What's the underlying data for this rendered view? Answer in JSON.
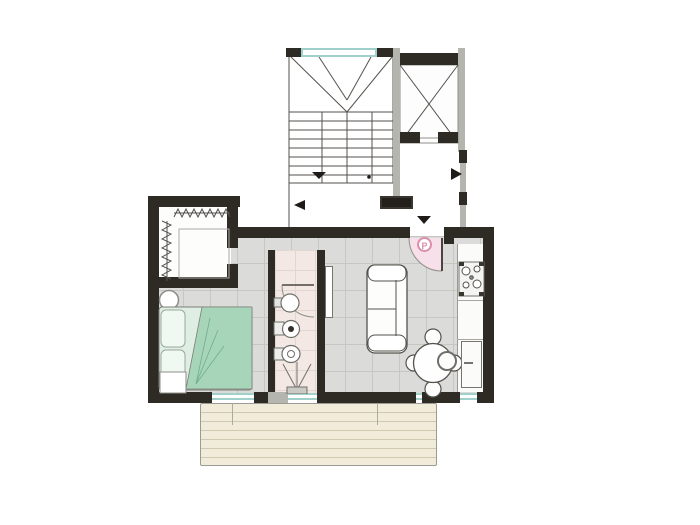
{
  "plan": {
    "entrance_marker": {
      "label": "P"
    },
    "colors": {
      "wall": "#2e2a24",
      "floor_tile": "#dbdbd9",
      "floor_grid": "#c6c6c3",
      "closet_floor": "#fdfdfc",
      "bathroom_floor": "#f3e8e3",
      "bathroom_grid": "#e2d6d0",
      "terrace_deck": "#f1ecda",
      "terrace_line": "#cfc9b2",
      "bed_green": "#a7d5b9",
      "bed_green_light": "#d8eddf",
      "marker_pink": "#db8fac",
      "marker_pink_light": "#f7e0e9",
      "window_glass": "#9fd0c9",
      "outline_dark": "#55524c",
      "outline_gray": "#b5b5b0"
    }
  }
}
